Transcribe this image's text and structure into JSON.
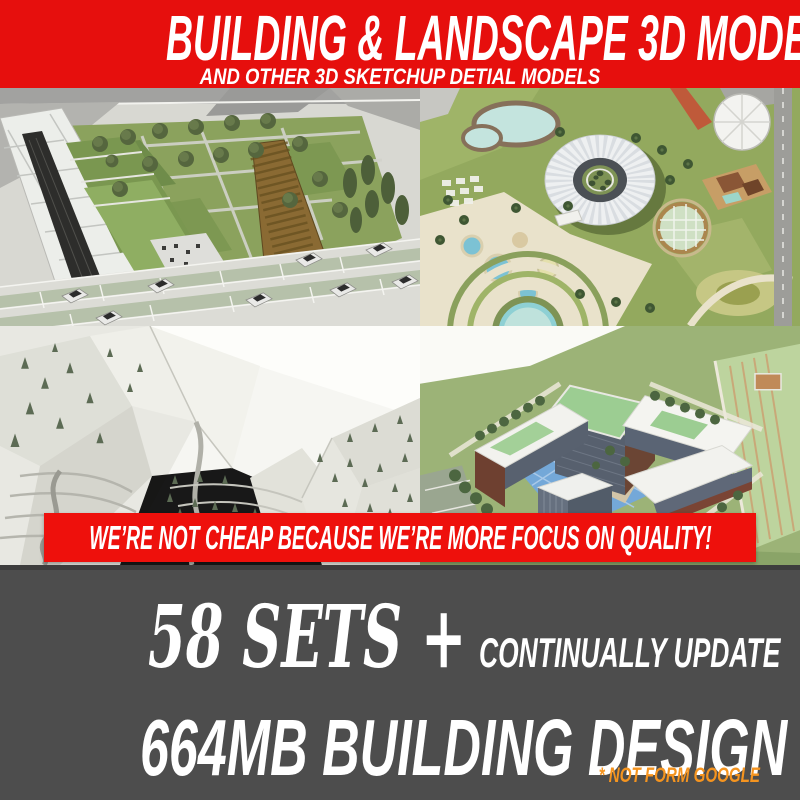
{
  "header": {
    "title": "BUILDING & LANDSCAPE 3D MODELS",
    "subtitle": "AND OTHER 3D SKETCHUP DETIAL MODELS"
  },
  "banner": {
    "text": "WE’RE NOT CHEAP BECAUSE WE’RE MORE FOCUS ON QUALITY!"
  },
  "footer": {
    "sets_line": "58 SETS +",
    "update_note": "CONTINUALLY UPDATE",
    "size_line": "664MB BUILDING DESIGN",
    "footnote": "* NOT FORM GOOGLE"
  },
  "colors": {
    "header_red": "#e60f0d",
    "quality_banner_red": "#ee100c",
    "footer_gray": "#4d4d4d",
    "footnote_orange": "#f5941f",
    "text_white": "#ffffff"
  },
  "gallery": {
    "items": [
      {
        "name": "park-plaza-aerial-render"
      },
      {
        "name": "circular-resort-park-aerial-render"
      },
      {
        "name": "white-terrain-model-render"
      },
      {
        "name": "campus-building-complex-aerial-render"
      }
    ]
  }
}
